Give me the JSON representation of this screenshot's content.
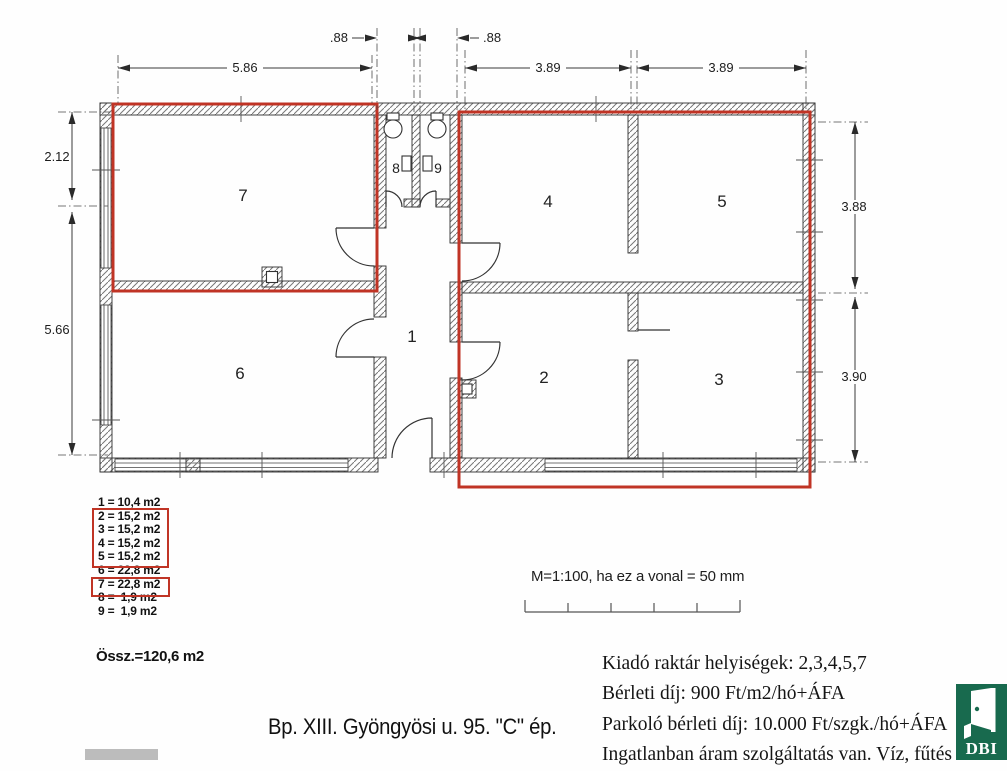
{
  "colors": {
    "highlight_red": "#c03425",
    "logo_green": "#186a4e",
    "wall_line": "#2f2f2f"
  },
  "plan": {
    "rooms": [
      "1",
      "2",
      "3",
      "4",
      "5",
      "6",
      "7",
      "8",
      "9"
    ],
    "dims": {
      "top_small_left": ".88",
      "top_small_right": ".88",
      "top_left": "5.86",
      "top_mid": "3.89",
      "top_right": "3.89",
      "left_upper": "2.12",
      "left_lower": "5.66",
      "right_upper": "3.88",
      "right_lower": "3.90"
    }
  },
  "legend": {
    "rows": [
      "1 = 10,4 m2",
      "2 = 15,2 m2",
      "3 = 15,2 m2",
      "4 = 15,2 m2",
      "5 = 15,2 m2",
      "6 = 22,8 m2",
      "7 = 22,8 m2",
      "8 =  1,9 m2",
      "9 =  1,9 m2"
    ],
    "total": "Össz.=120,6 m2"
  },
  "scale_note": "M=1:100, ha ez a vonal = 50 mm",
  "title": "Bp. XIII. Gyöngyösi u. 95. \"C\" ép.",
  "info_lines": [
    "Kiadó raktár helyiségek: 2,3,4,5,7",
    "Bérleti díj: 900 Ft/m2/hó+ÁFA",
    "Parkoló bérleti díj: 10.000 Ft/szgk./hó+ÁFA",
    "Ingatlanban áram szolgáltatás van. Víz, fűtés nin"
  ],
  "logo": {
    "text": "DBI"
  }
}
